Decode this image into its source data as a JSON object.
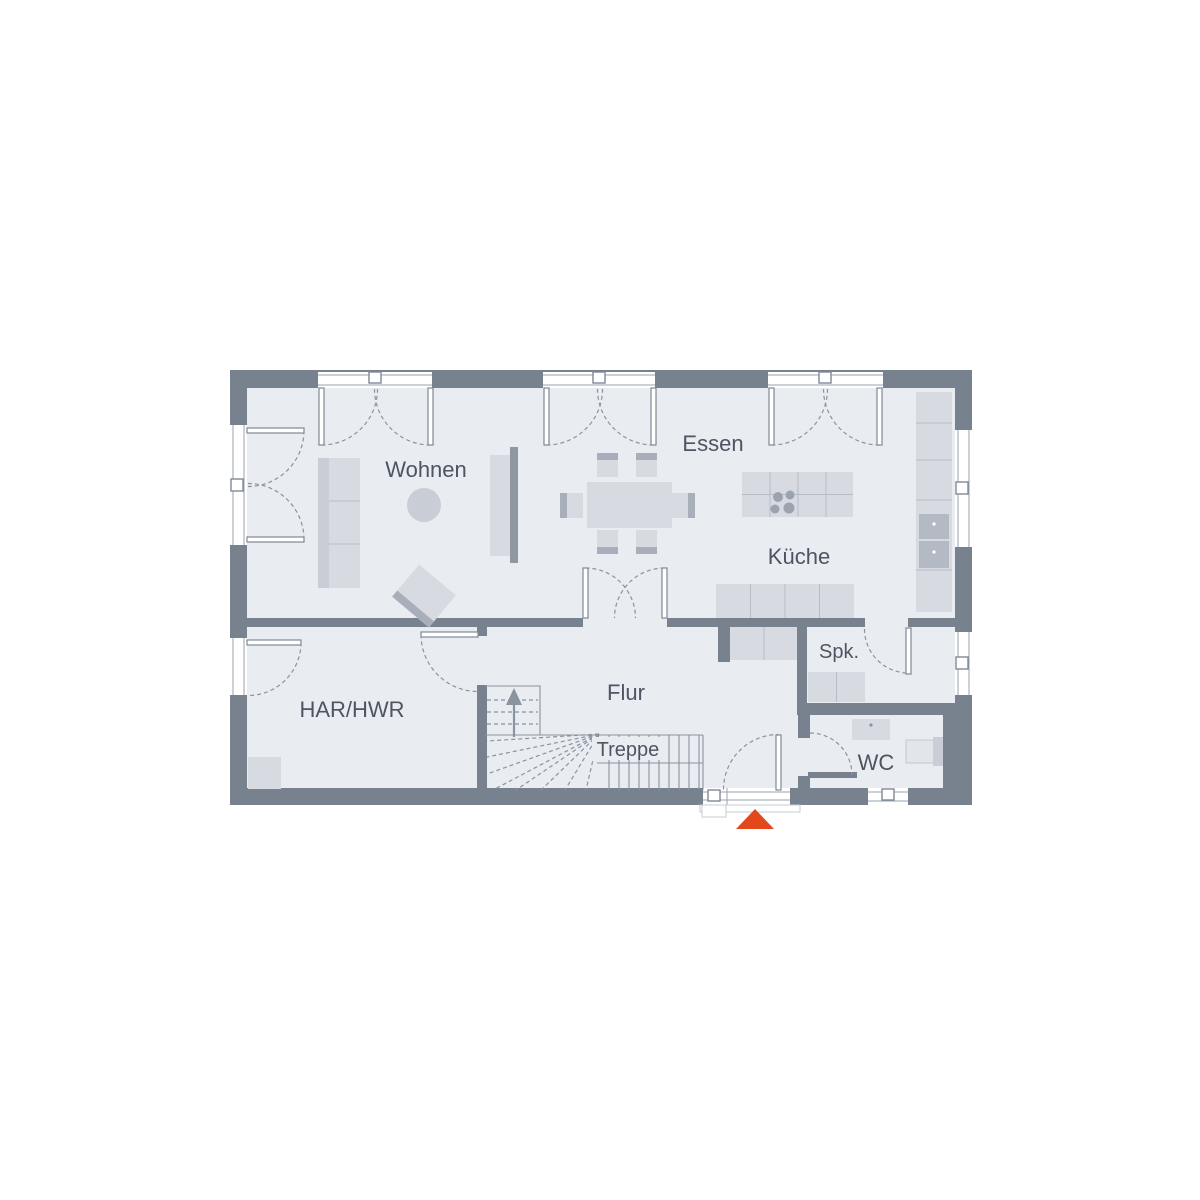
{
  "plan": {
    "type": "floor-plan",
    "rooms": {
      "wohnen": {
        "label": "Wohnen"
      },
      "essen": {
        "label": "Essen"
      },
      "kueche": {
        "label": "Küche"
      },
      "flur": {
        "label": "Flur"
      },
      "treppe": {
        "label": "Treppe"
      },
      "har_hwr": {
        "label": "HAR/HWR"
      },
      "spk": {
        "label": "Spk."
      },
      "wc": {
        "label": "WC"
      }
    },
    "colors": {
      "wall": "#78828f",
      "floor": "#e9ecf1",
      "furniture_light": "#d7dbe1",
      "furniture_mid": "#c9ced6",
      "furniture_dark": "#a8afba",
      "line": "#8a93a0",
      "label_text": "#4d5562",
      "entrance_accent": "#e2481c"
    },
    "entrance_marker": {
      "icon": "triangle-up-icon"
    }
  }
}
